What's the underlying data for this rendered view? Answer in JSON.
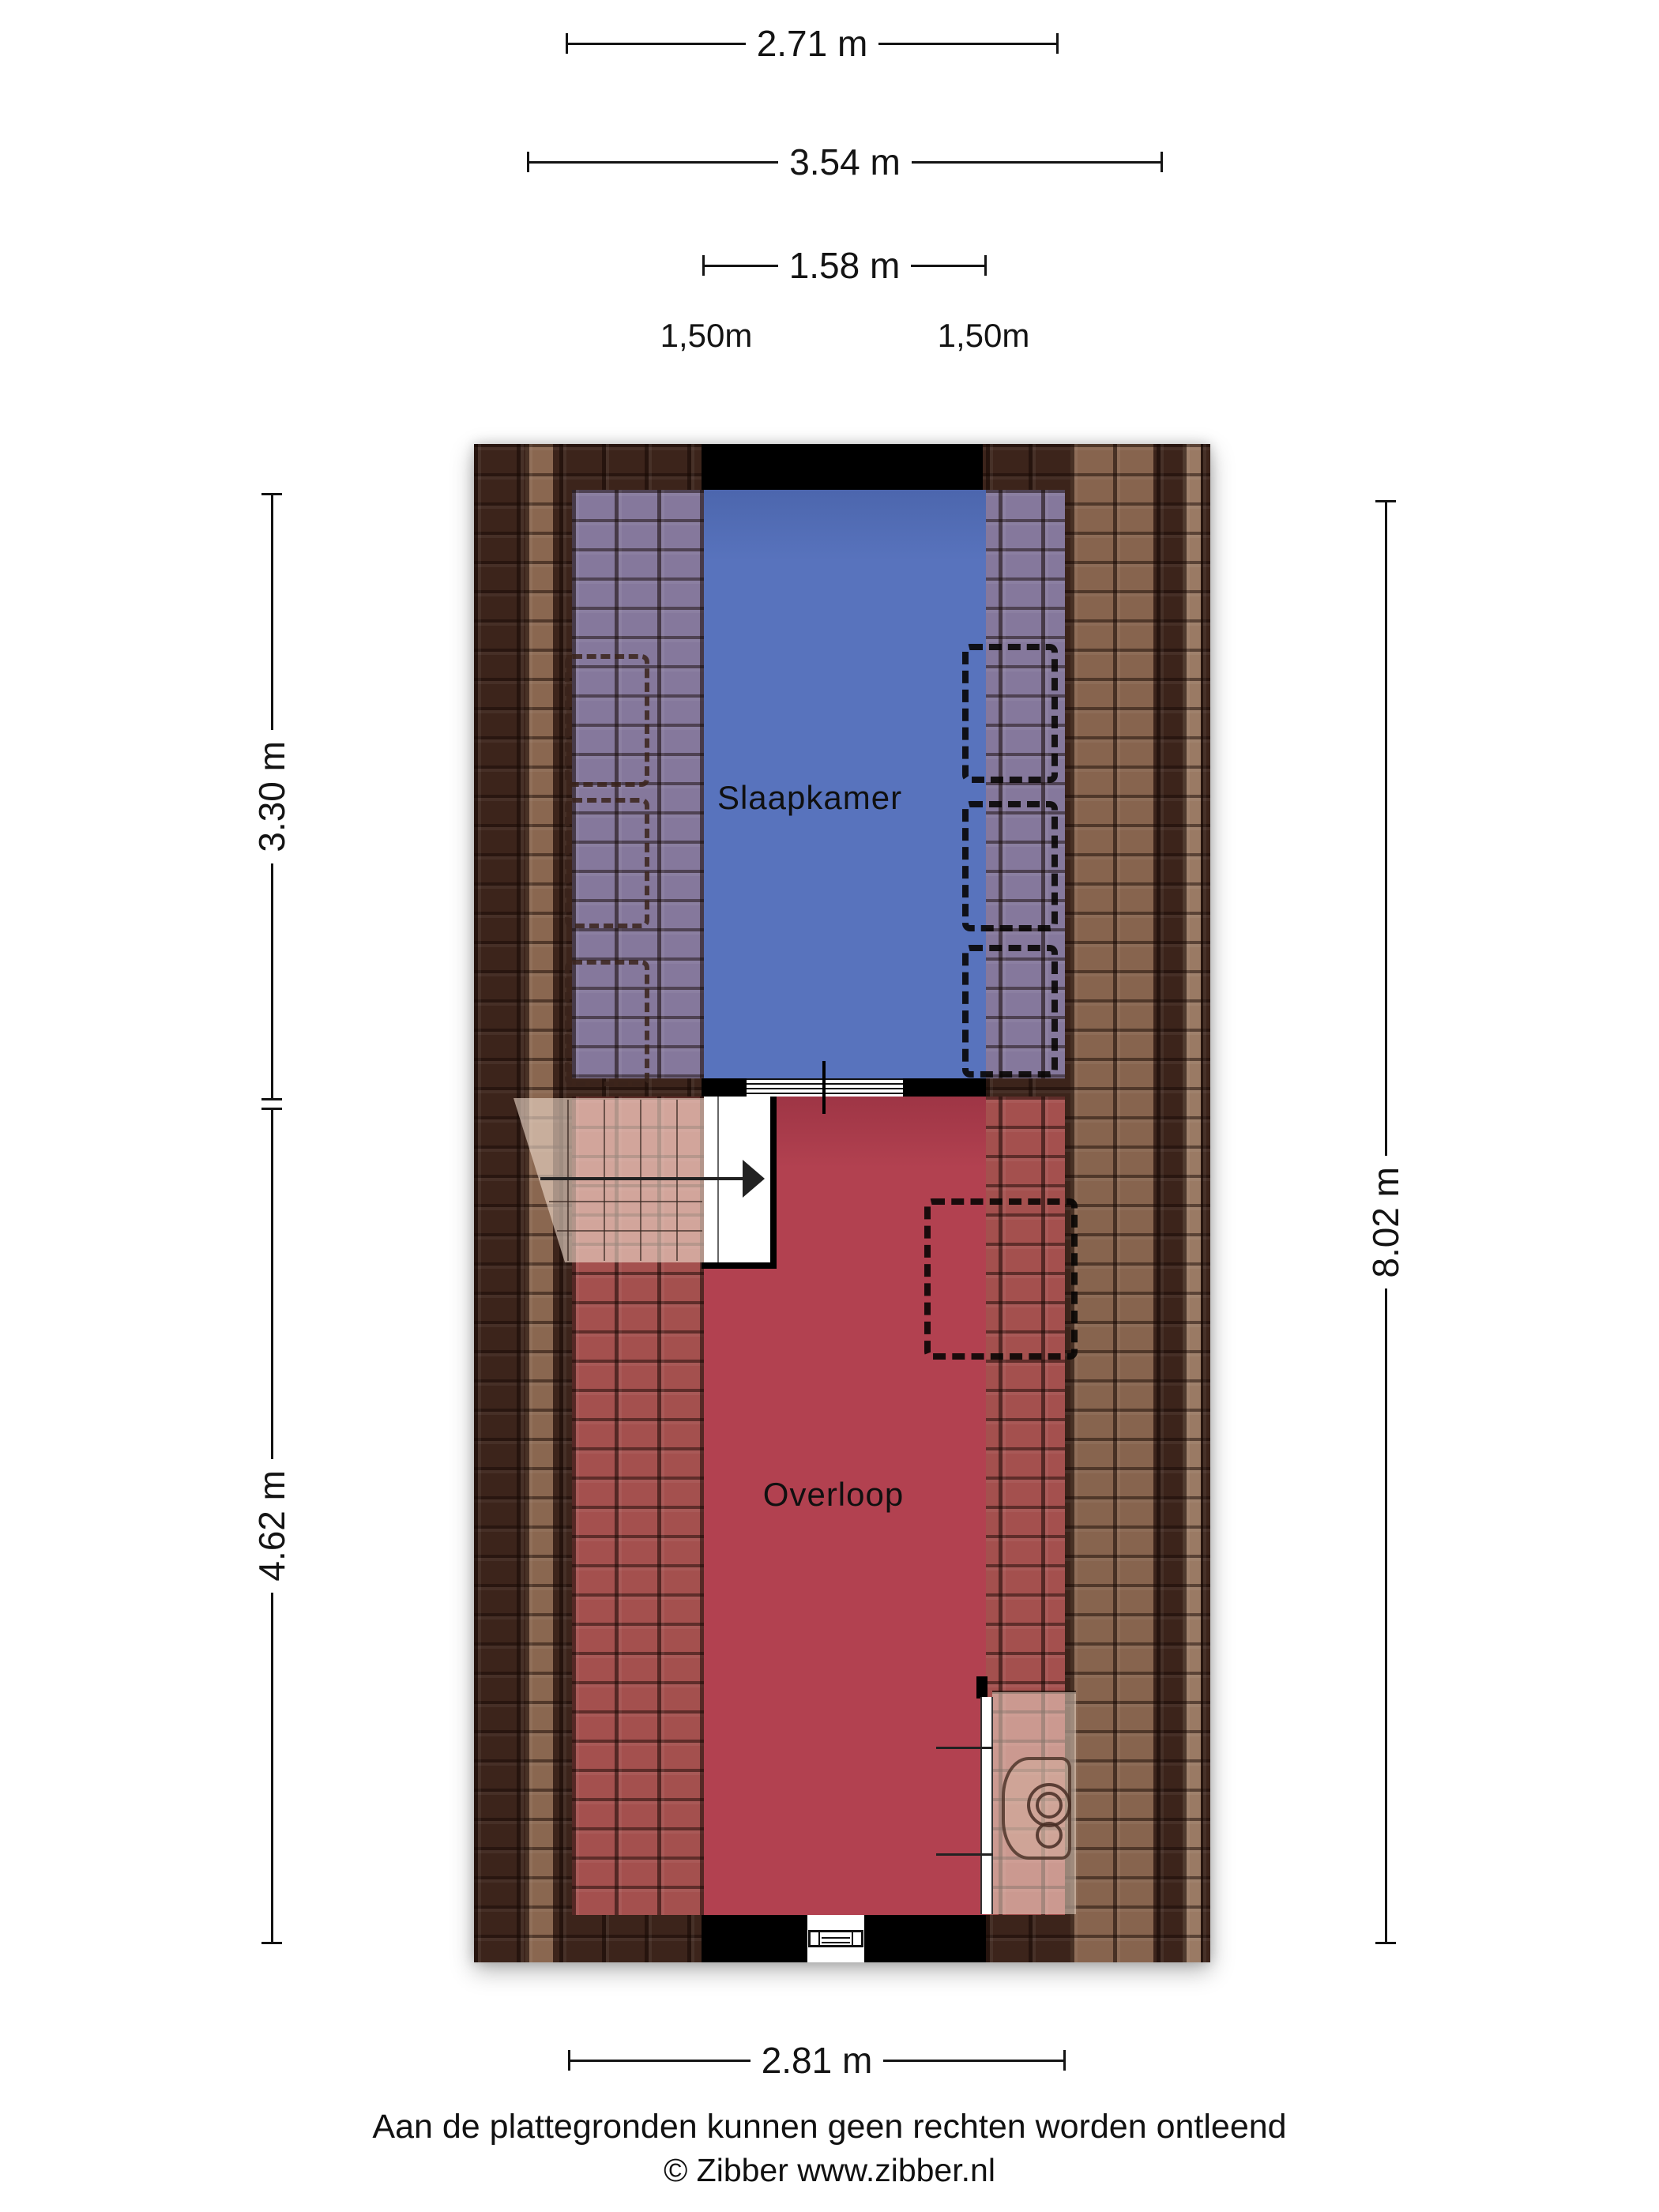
{
  "plan": {
    "type": "floorplan-attic-floor",
    "rooms": [
      {
        "label": "Slaapkamer",
        "fill": "#5873bd",
        "roof_tint": "#85789c"
      },
      {
        "label": "Overloop",
        "fill": "#b24150",
        "roof_tint": "#a4504e"
      }
    ],
    "features": {
      "stair": "staircase with direction arrow in Overloop",
      "toilet": "toilet fixture in alcove at bottom right",
      "window": "window in bottom wall",
      "door": "door opening between Slaapkamer and Overloop",
      "wardrobes": "dashed low-headroom storage outlines along sloped roof sides"
    }
  },
  "dimensions": {
    "top": [
      {
        "label": "2.71 m"
      },
      {
        "label": "3.54 m"
      },
      {
        "label": "1.58 m"
      }
    ],
    "height_markers": [
      {
        "label": "1,50m"
      },
      {
        "label": "1,50m"
      }
    ],
    "bottom": [
      {
        "label": "2.81 m"
      }
    ],
    "left": [
      {
        "label": "3.30 m"
      },
      {
        "label": "4.62 m"
      }
    ],
    "right": [
      {
        "label": "8.02 m"
      }
    ]
  },
  "footer": {
    "disclaimer": "Aan de plattegronden kunnen geen rechten worden ontleend",
    "copyright": "© Zibber www.zibber.nl"
  },
  "colors": {
    "roof_dark": "#3c241b",
    "roof_light_strip": "#8a6750",
    "slaapkamer_fill": "#5873bd",
    "slaapkamer_roof_tint": "#85789c",
    "overloop_fill": "#b24150",
    "overloop_roof_tint": "#a4504e",
    "wall": "#000000",
    "stair_overlay": "#f2ded0",
    "text": "#141414"
  },
  "icons": {
    "stair_direction_arrow": "right-pointing triangle",
    "toilet": "toilet top view with flush buttons",
    "window": "triple-pane window symbol",
    "door": "threshold with step lines"
  }
}
